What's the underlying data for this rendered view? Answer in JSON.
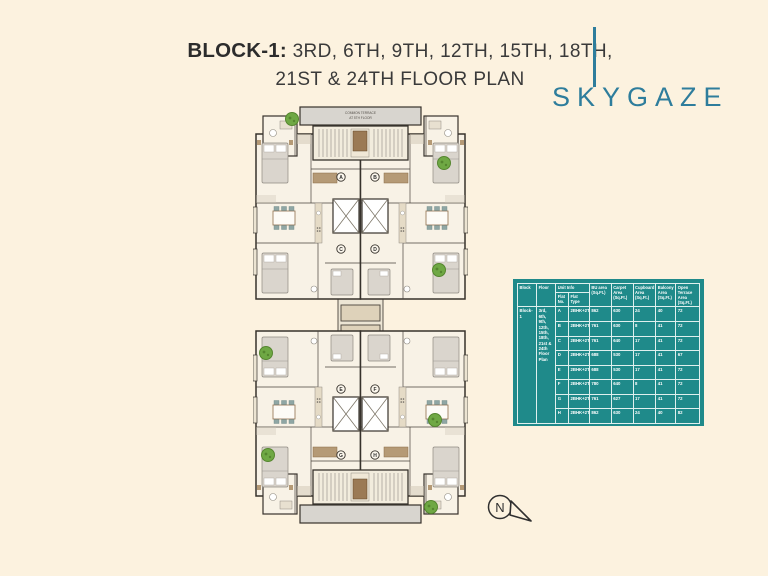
{
  "title": {
    "prefix": "BLOCK-1:",
    "line1": "3RD, 6TH, 9TH, 12TH, 15TH, 18TH,",
    "line2": "21ST & 24TH FLOOR PLAN"
  },
  "logo": {
    "text": "SKYGAZE",
    "color": "#2e7d9c"
  },
  "plan": {
    "terrace_label_1": "COMMON TERRACE",
    "terrace_label_2": "AT 5TH FLOOR",
    "unit_markers": [
      "A",
      "B",
      "C",
      "D",
      "E",
      "F",
      "G",
      "H"
    ]
  },
  "compass": {
    "label": "N"
  },
  "colors": {
    "background": "#fcf2df",
    "table_teal": "#1f8a8a",
    "logo_teal": "#2e7d9c",
    "wall": "#37322c",
    "tree_green": "#6fa844"
  },
  "table": {
    "headers": {
      "block": "Block",
      "floor": "Floor",
      "unit_info": "Unit Info",
      "flat_no": "Flat No.",
      "flat_type": "Flat Type",
      "bu_area": "BU area (Sq.Ft.)",
      "carpet": "Carpet Area (Sq.Ft.)",
      "cupboard": "Cupboard Area (Sq.Ft.)",
      "balcony": "Balcony Area (Sq.Ft.)",
      "open_terrace": "Open Terrace Area (Sq.Ft.)"
    },
    "block_value": "Block-1",
    "floor_value": "3rd, 6th, 9th, 12th, 15th, 18th, 21st & 24th Floor Plan",
    "rows": [
      [
        "A",
        "2BHK+2T",
        "862",
        "630",
        "24",
        "40",
        "72"
      ],
      [
        "B",
        "2BHK+2T",
        "761",
        "630",
        "8",
        "41",
        "72"
      ],
      [
        "C",
        "2BHK+2T",
        "761",
        "640",
        "17",
        "41",
        "72"
      ],
      [
        "D",
        "2BHK+2T",
        "688",
        "530",
        "17",
        "41",
        "67"
      ],
      [
        "E",
        "2BHK+2T",
        "688",
        "530",
        "17",
        "41",
        "72"
      ],
      [
        "F",
        "2BHK+2T",
        "780",
        "640",
        "8",
        "41",
        "72"
      ],
      [
        "G",
        "2BHK+2T",
        "761",
        "627",
        "17",
        "41",
        "72"
      ],
      [
        "H",
        "2BHK+2T",
        "862",
        "630",
        "24",
        "40",
        "82"
      ]
    ]
  }
}
